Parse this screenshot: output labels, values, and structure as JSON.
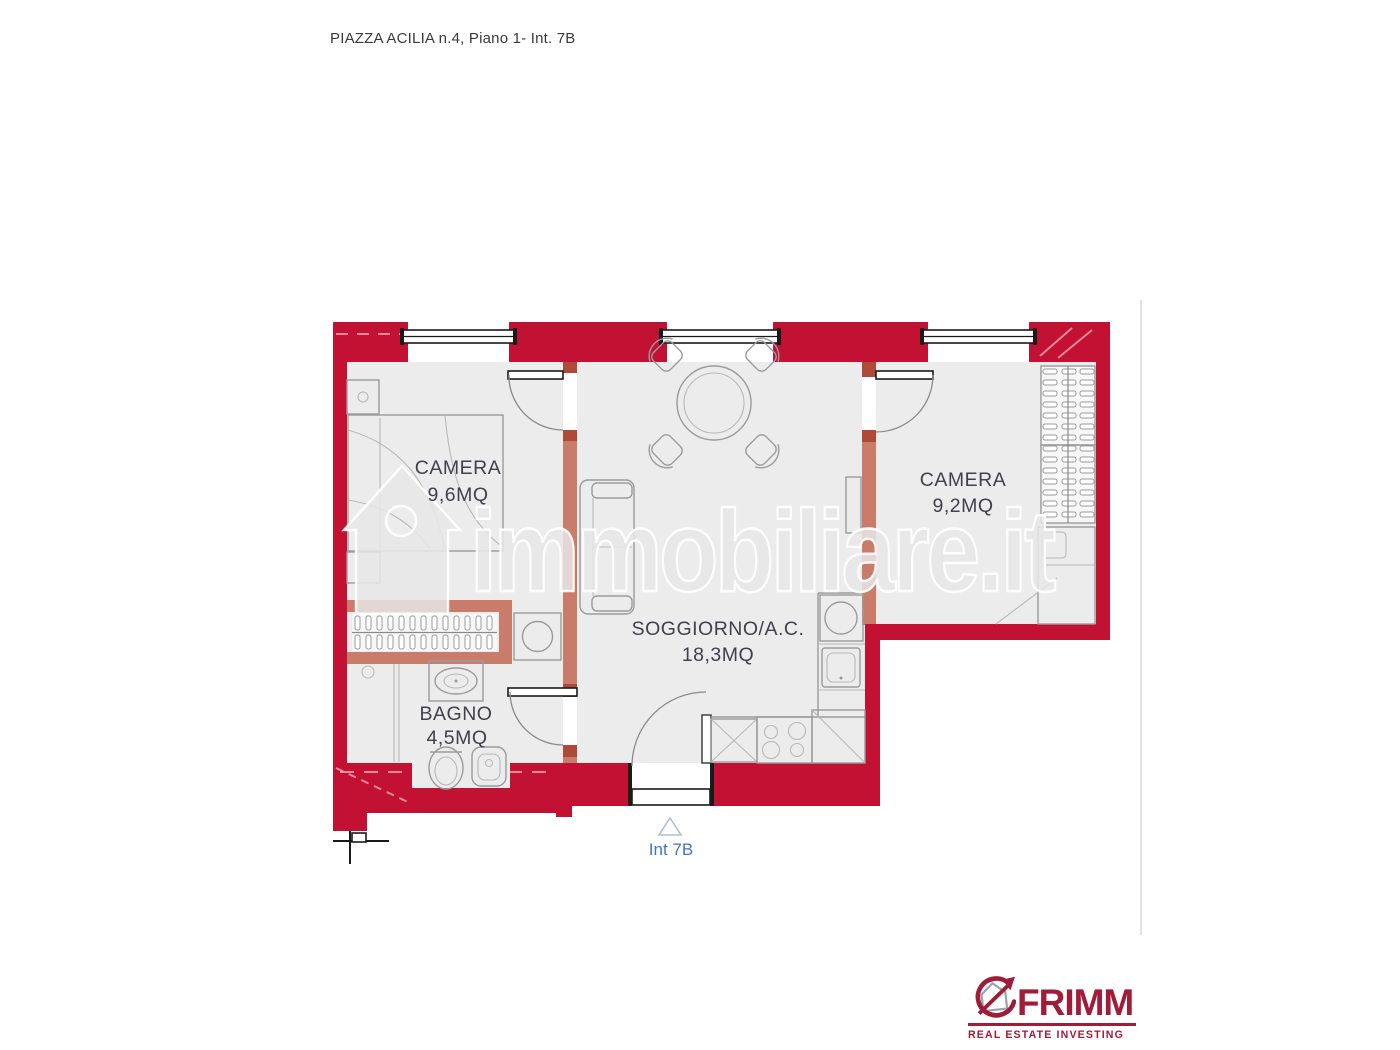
{
  "page": {
    "title": "PIAZZA ACILIA n.4, Piano 1- Int. 7B"
  },
  "floorplan": {
    "rooms": [
      {
        "id": "camera-1",
        "name": "CAMERA",
        "area": "9,6MQ"
      },
      {
        "id": "camera-2",
        "name": "CAMERA",
        "area": "9,2MQ"
      },
      {
        "id": "soggiorno",
        "name": "SOGGIORNO/A.C.",
        "area": "18,3MQ"
      },
      {
        "id": "bagno",
        "name": "BAGNO",
        "area": "4,5MQ"
      }
    ],
    "entrance": {
      "label": "Int 7B",
      "marker_icon": "triangle-up-icon"
    }
  },
  "watermark": {
    "text": "immobiliare.it",
    "icon": "house-watermark-icon"
  },
  "brand": {
    "name": "FRIMM",
    "tagline": "REAL ESTATE INVESTING",
    "mark_icon": "house-arrow-icon"
  },
  "colors": {
    "wall_exterior_red": "#c31133",
    "wall_interior_salmon": "#c97c6a",
    "door_cap_dark": "#b04a38",
    "floor_gray": "#ececec",
    "furniture_line_gray": "#9b9b9b",
    "structure_black": "#1a1a1a",
    "room_label": "#41414b",
    "entrance_blue": "#3f74c9",
    "watermark_gray": "#e7e7e7",
    "brand_maroon": "#a01c38"
  }
}
